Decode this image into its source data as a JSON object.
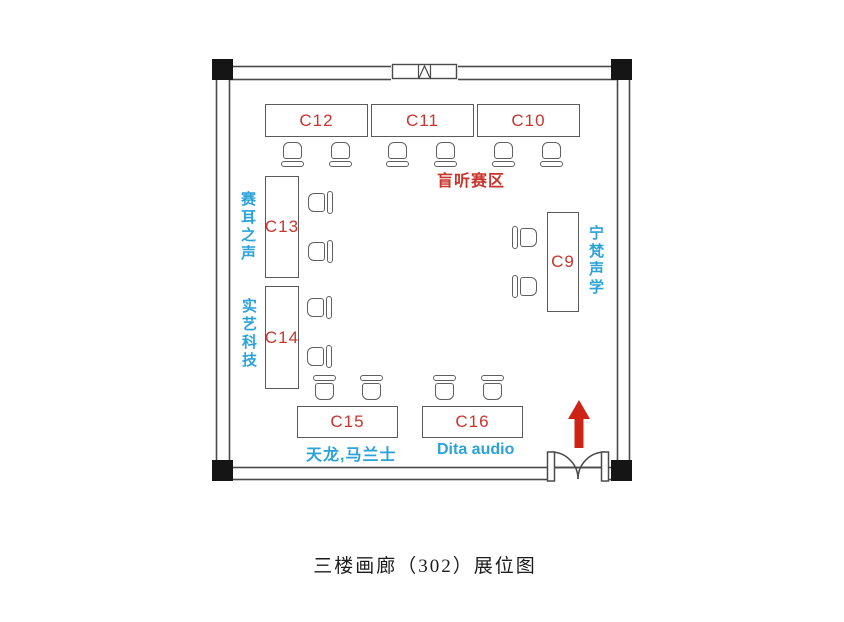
{
  "title": "三楼画廊（302）展位图",
  "booths": [
    {
      "id": "c12",
      "label": "C12"
    },
    {
      "id": "c11",
      "label": "C11"
    },
    {
      "id": "c10",
      "label": "C10"
    },
    {
      "id": "c13",
      "label": "C13"
    },
    {
      "id": "c14",
      "label": "C14"
    },
    {
      "id": "c9",
      "label": "C9"
    },
    {
      "id": "c15",
      "label": "C15"
    },
    {
      "id": "c16",
      "label": "C16"
    }
  ],
  "zone_labels": {
    "blind_listening": "盲听赛区",
    "saier": "赛耳之声",
    "shiyi": "实艺科技",
    "ningfan": "宁梵声学",
    "tianlong": "天龙,马兰士",
    "dita": "Dita audio"
  },
  "icons": {
    "chair": "chair-icon",
    "double_door": "double-door-icon",
    "window": "window-icon",
    "entrance_arrow": "entrance-arrow-icon",
    "corner_post": "corner-post"
  },
  "colors": {
    "booth_text_red": "#C8352C",
    "zone_blue": "#2BA3D8",
    "arrow_red": "#CE2418",
    "wall_line": "#4A4A4A",
    "corner_post_black": "#151515",
    "background": "#FFFFFF"
  }
}
